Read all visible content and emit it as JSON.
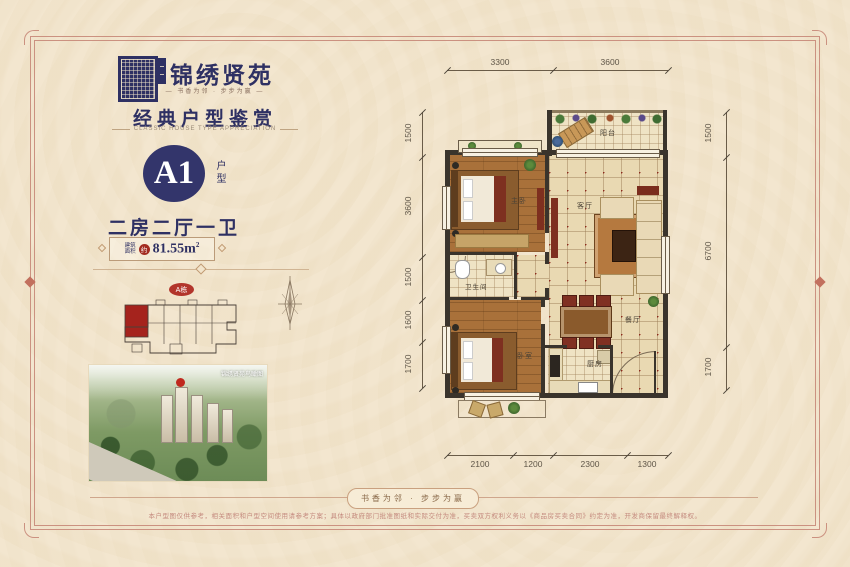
{
  "brand": {
    "name": "锦绣贤苑",
    "tagline": "—  书香为邻 · 步步为赢  —"
  },
  "section": {
    "title": "经典户型鉴赏",
    "subtitle": "CLASSIC HOUSE TYPE APPRECIATION"
  },
  "unit": {
    "code": "A1",
    "code_label": "户型",
    "layout": "二房二厅一卫",
    "area_label_line1": "建筑",
    "area_label_line2": "面积",
    "area_prefix": "约",
    "area_value": "81.55m",
    "area_sup": "2"
  },
  "siteplan": {
    "building_badge": "A栋",
    "photo_caption": "锦绣贤苑鸟瞰图"
  },
  "floorplan": {
    "rooms": {
      "balcony": "阳台",
      "master": "主卧",
      "living": "客厅",
      "bathroom": "卫生间",
      "bedroom2": "卧室",
      "dining": "餐厅",
      "kitchen": "厨房"
    },
    "dims_top": [
      "3300",
      "3600"
    ],
    "dims_left": [
      "1500",
      "3600",
      "1500",
      "1600",
      "1700"
    ],
    "dims_right": [
      "1500",
      "6700",
      "1700"
    ],
    "dims_bottom": [
      "2100",
      "1200",
      "2300",
      "1300"
    ]
  },
  "footer": {
    "banner": "书香为邻 · 步步为赢",
    "disclaimer": "本户型图仅供参考，相关面积和户型空间使用请参考方案；具体以政府部门批准图纸和实际交付为准，买卖双方权利义务以《商品房买卖合同》约定为准，开发商保留最终解释权。"
  }
}
